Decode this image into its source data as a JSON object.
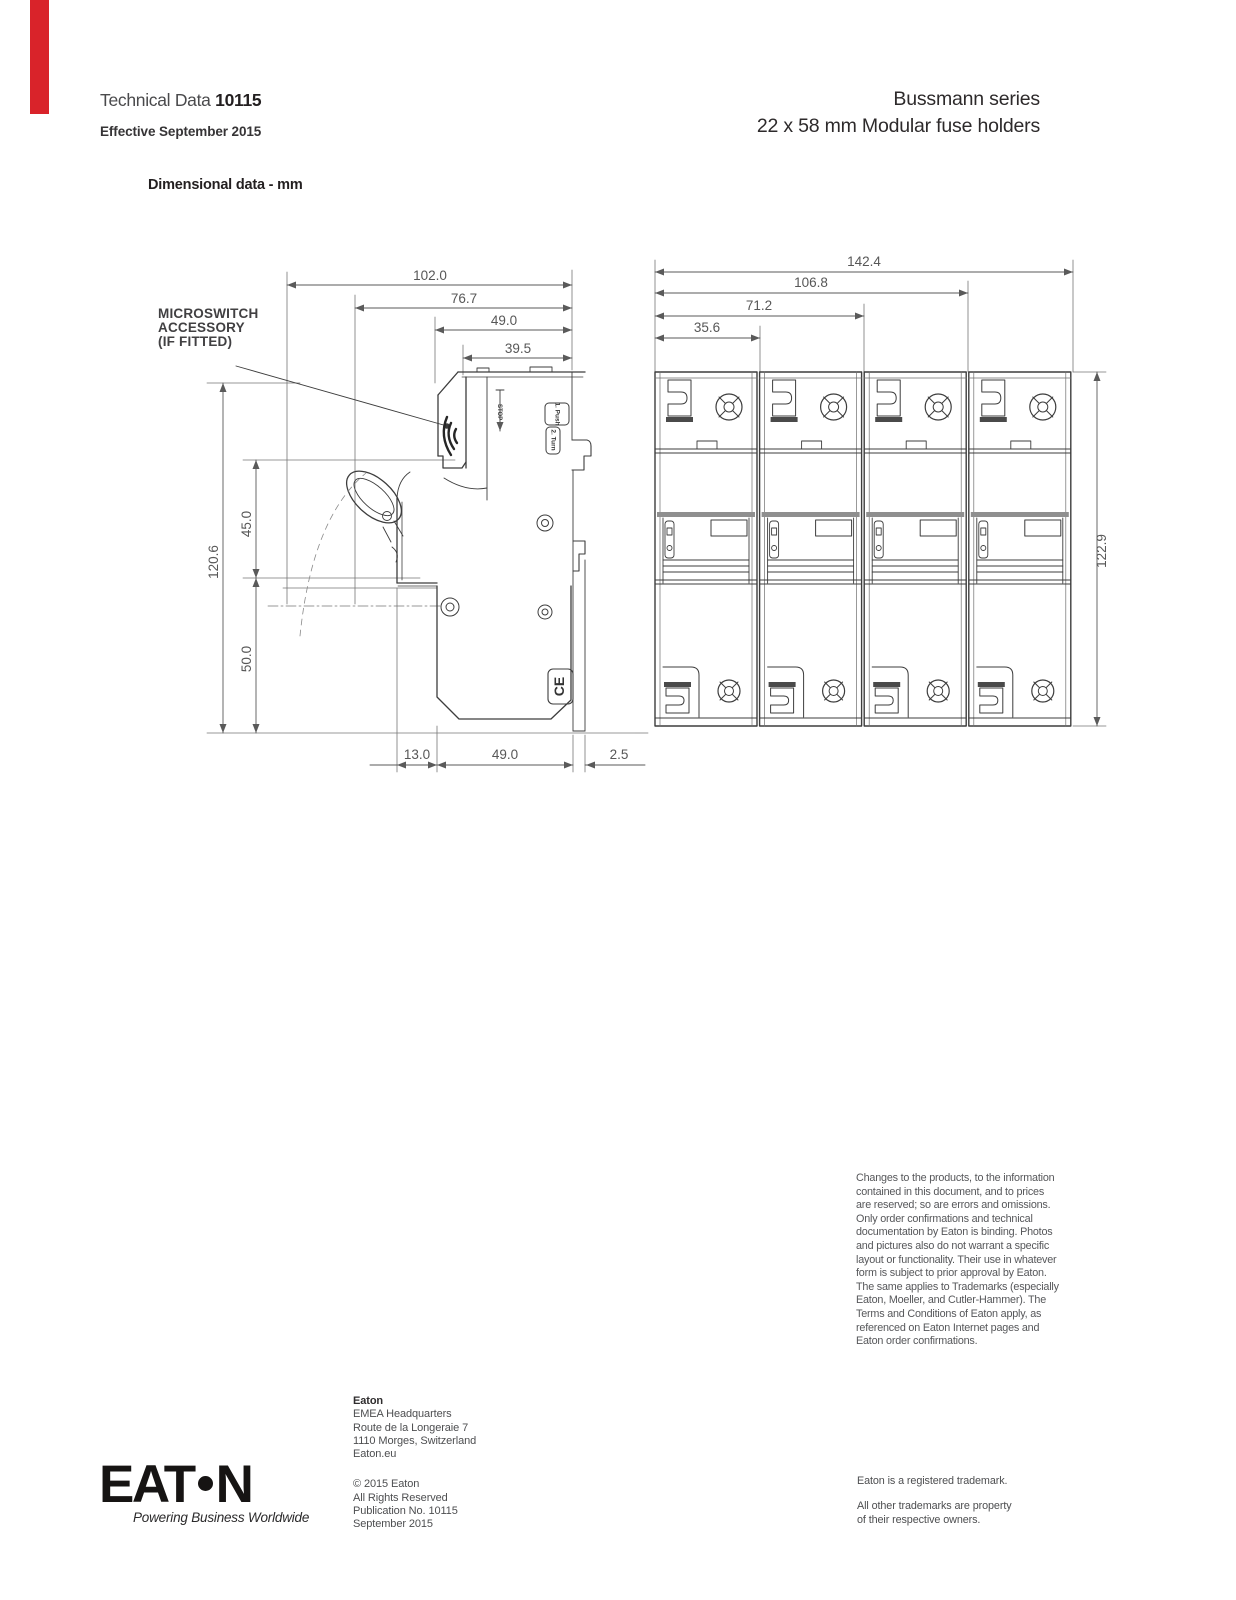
{
  "accent": {
    "edge_bar_color": "#d9232a"
  },
  "header": {
    "doc_type": "Technical Data",
    "doc_number": "10115",
    "effective": "Effective September 2015",
    "series": "Bussmann series",
    "product": "22 x 58 mm Modular fuse holders",
    "section_title": "Dimensional data - mm"
  },
  "side_view": {
    "callout_line1": "MICROSWITCH",
    "callout_line2": "ACCESSORY",
    "callout_line3": "(IF FITTED)",
    "dim_overall_width": "102.0",
    "dim_width_2": "76.7",
    "dim_width_3": "49.0",
    "dim_width_4": "39.5",
    "dim_overall_height": "120.6",
    "dim_height_upper": "45.0",
    "dim_height_lower": "50.0",
    "dim_bottom_1": "13.0",
    "dim_bottom_2": "49.0",
    "dim_bottom_3": "2.5",
    "marking_stop": "STOP",
    "marking_push": "1. Push",
    "marking_turn": "2. Turn",
    "marking_ce": "CE"
  },
  "front_view": {
    "dim_overall_width": "142.4",
    "dim_width_2": "106.8",
    "dim_width_3": "71.2",
    "dim_width_4": "35.6",
    "dim_overall_height": "122.9"
  },
  "legal": {
    "lines": [
      "Changes to the products, to the information",
      "contained in this document, and to prices",
      "are reserved; so are errors and omissions.",
      "Only order confirmations and technical",
      "documentation by Eaton is binding. Photos",
      "and pictures also do not warrant a specific",
      "layout or functionality. Their use in whatever",
      "form is subject to prior approval by Eaton.",
      "The same applies to Trademarks (especially",
      "Eaton, Moeller, and Cutler-Hammer). The",
      "Terms and Conditions of Eaton apply, as",
      "referenced on Eaton Internet pages and",
      "Eaton order confirmations."
    ]
  },
  "footer": {
    "company": "Eaton",
    "address_lines": [
      "EMEA Headquarters",
      "Route de la Longeraie 7",
      "1110 Morges, Switzerland",
      "Eaton.eu"
    ],
    "copyright_lines": [
      "© 2015 Eaton",
      "All Rights Reserved",
      "Publication No. 10115",
      "September 2015"
    ],
    "trademark_line1": "Eaton is a registered trademark.",
    "trademark_line2": "All other trademarks are property",
    "trademark_line3": "of their respective owners.",
    "logo": {
      "part1": "EAT",
      "part2": "N",
      "tagline": "Powering Business Worldwide"
    }
  }
}
